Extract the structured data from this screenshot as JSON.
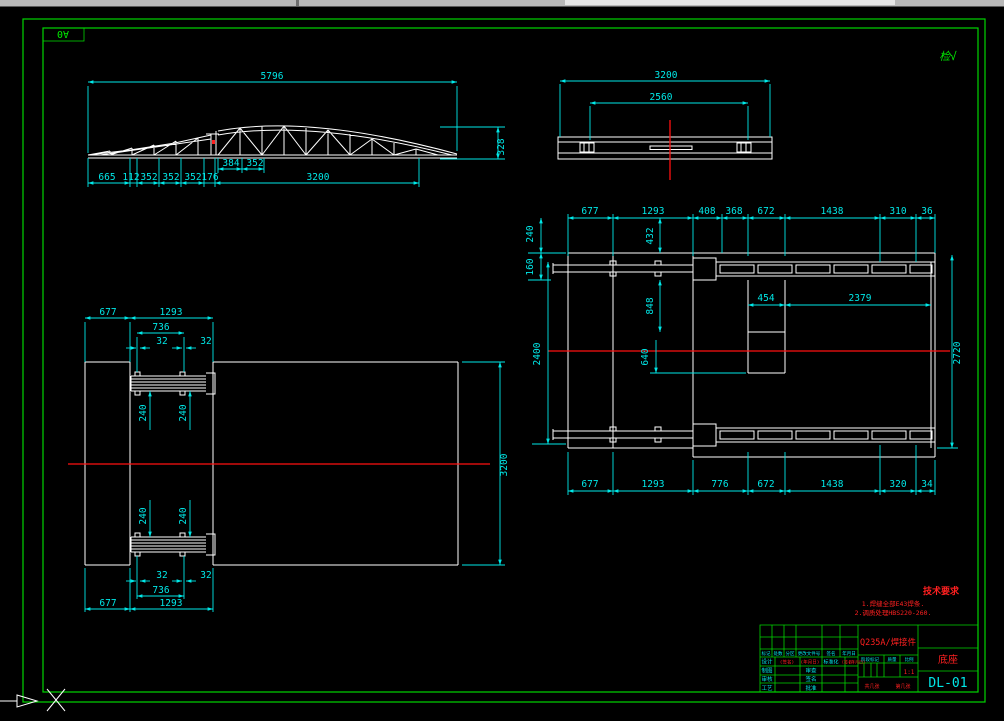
{
  "sheet": {
    "size_label": "A0",
    "approval_mark": "检√"
  },
  "tech_requirements": {
    "title": "技术要求",
    "lines": [
      "1.焊缝全部E43焊条.",
      "2.调质处理HBS220-260."
    ]
  },
  "title_block": {
    "material": "Q235A/焊接件",
    "part_name": "底座",
    "drawing_no": "DL-01",
    "scale_label": "1:1",
    "sheet_total": "共几张",
    "sheet_index": "第几张",
    "change_header": [
      "标记",
      "处数",
      "分区",
      "更改文件号",
      "签名",
      "年月日"
    ],
    "rows": [
      {
        "left": "设计",
        "sig": "(签名)",
        "date": "(年月日)",
        "mid": "标准化",
        "sig2": "(签名)",
        "date2": "(年月日)"
      },
      {
        "left": "制图",
        "mid": "审查"
      },
      {
        "left": "审核",
        "mid": "签名"
      },
      {
        "left": "工艺",
        "mid": "批准"
      }
    ],
    "stage_headers": [
      "阶段标记",
      "质量",
      "比例"
    ]
  },
  "views": {
    "truss": {
      "dim_top": "5796",
      "dim_height": "328",
      "dim_sub": [
        "384",
        "352"
      ],
      "dim_bottom": [
        "665",
        "112",
        "352",
        "352",
        "352",
        "176",
        "3200"
      ]
    },
    "plate": {
      "dim_outer": "3200",
      "dim_inner": "2560"
    },
    "plan_left": {
      "top": [
        "677",
        "1293",
        "736",
        "32",
        "32"
      ],
      "mid_upper": [
        "240",
        "240"
      ],
      "mid_lower": [
        "240",
        "240"
      ],
      "right": "3200",
      "bottom": [
        "32",
        "32",
        "736",
        "677",
        "1293"
      ]
    },
    "plan_right": {
      "top": [
        "677",
        "1293",
        "408",
        "368",
        "672",
        "1438",
        "310",
        "36"
      ],
      "bottom": [
        "677",
        "1293",
        "776",
        "672",
        "1438",
        "320",
        "34"
      ],
      "left": [
        "240",
        "160",
        "2400"
      ],
      "inner": [
        "432",
        "848",
        "640",
        "454",
        "2379"
      ],
      "right": "2720"
    }
  },
  "ucs": {
    "axis_label": "X"
  }
}
